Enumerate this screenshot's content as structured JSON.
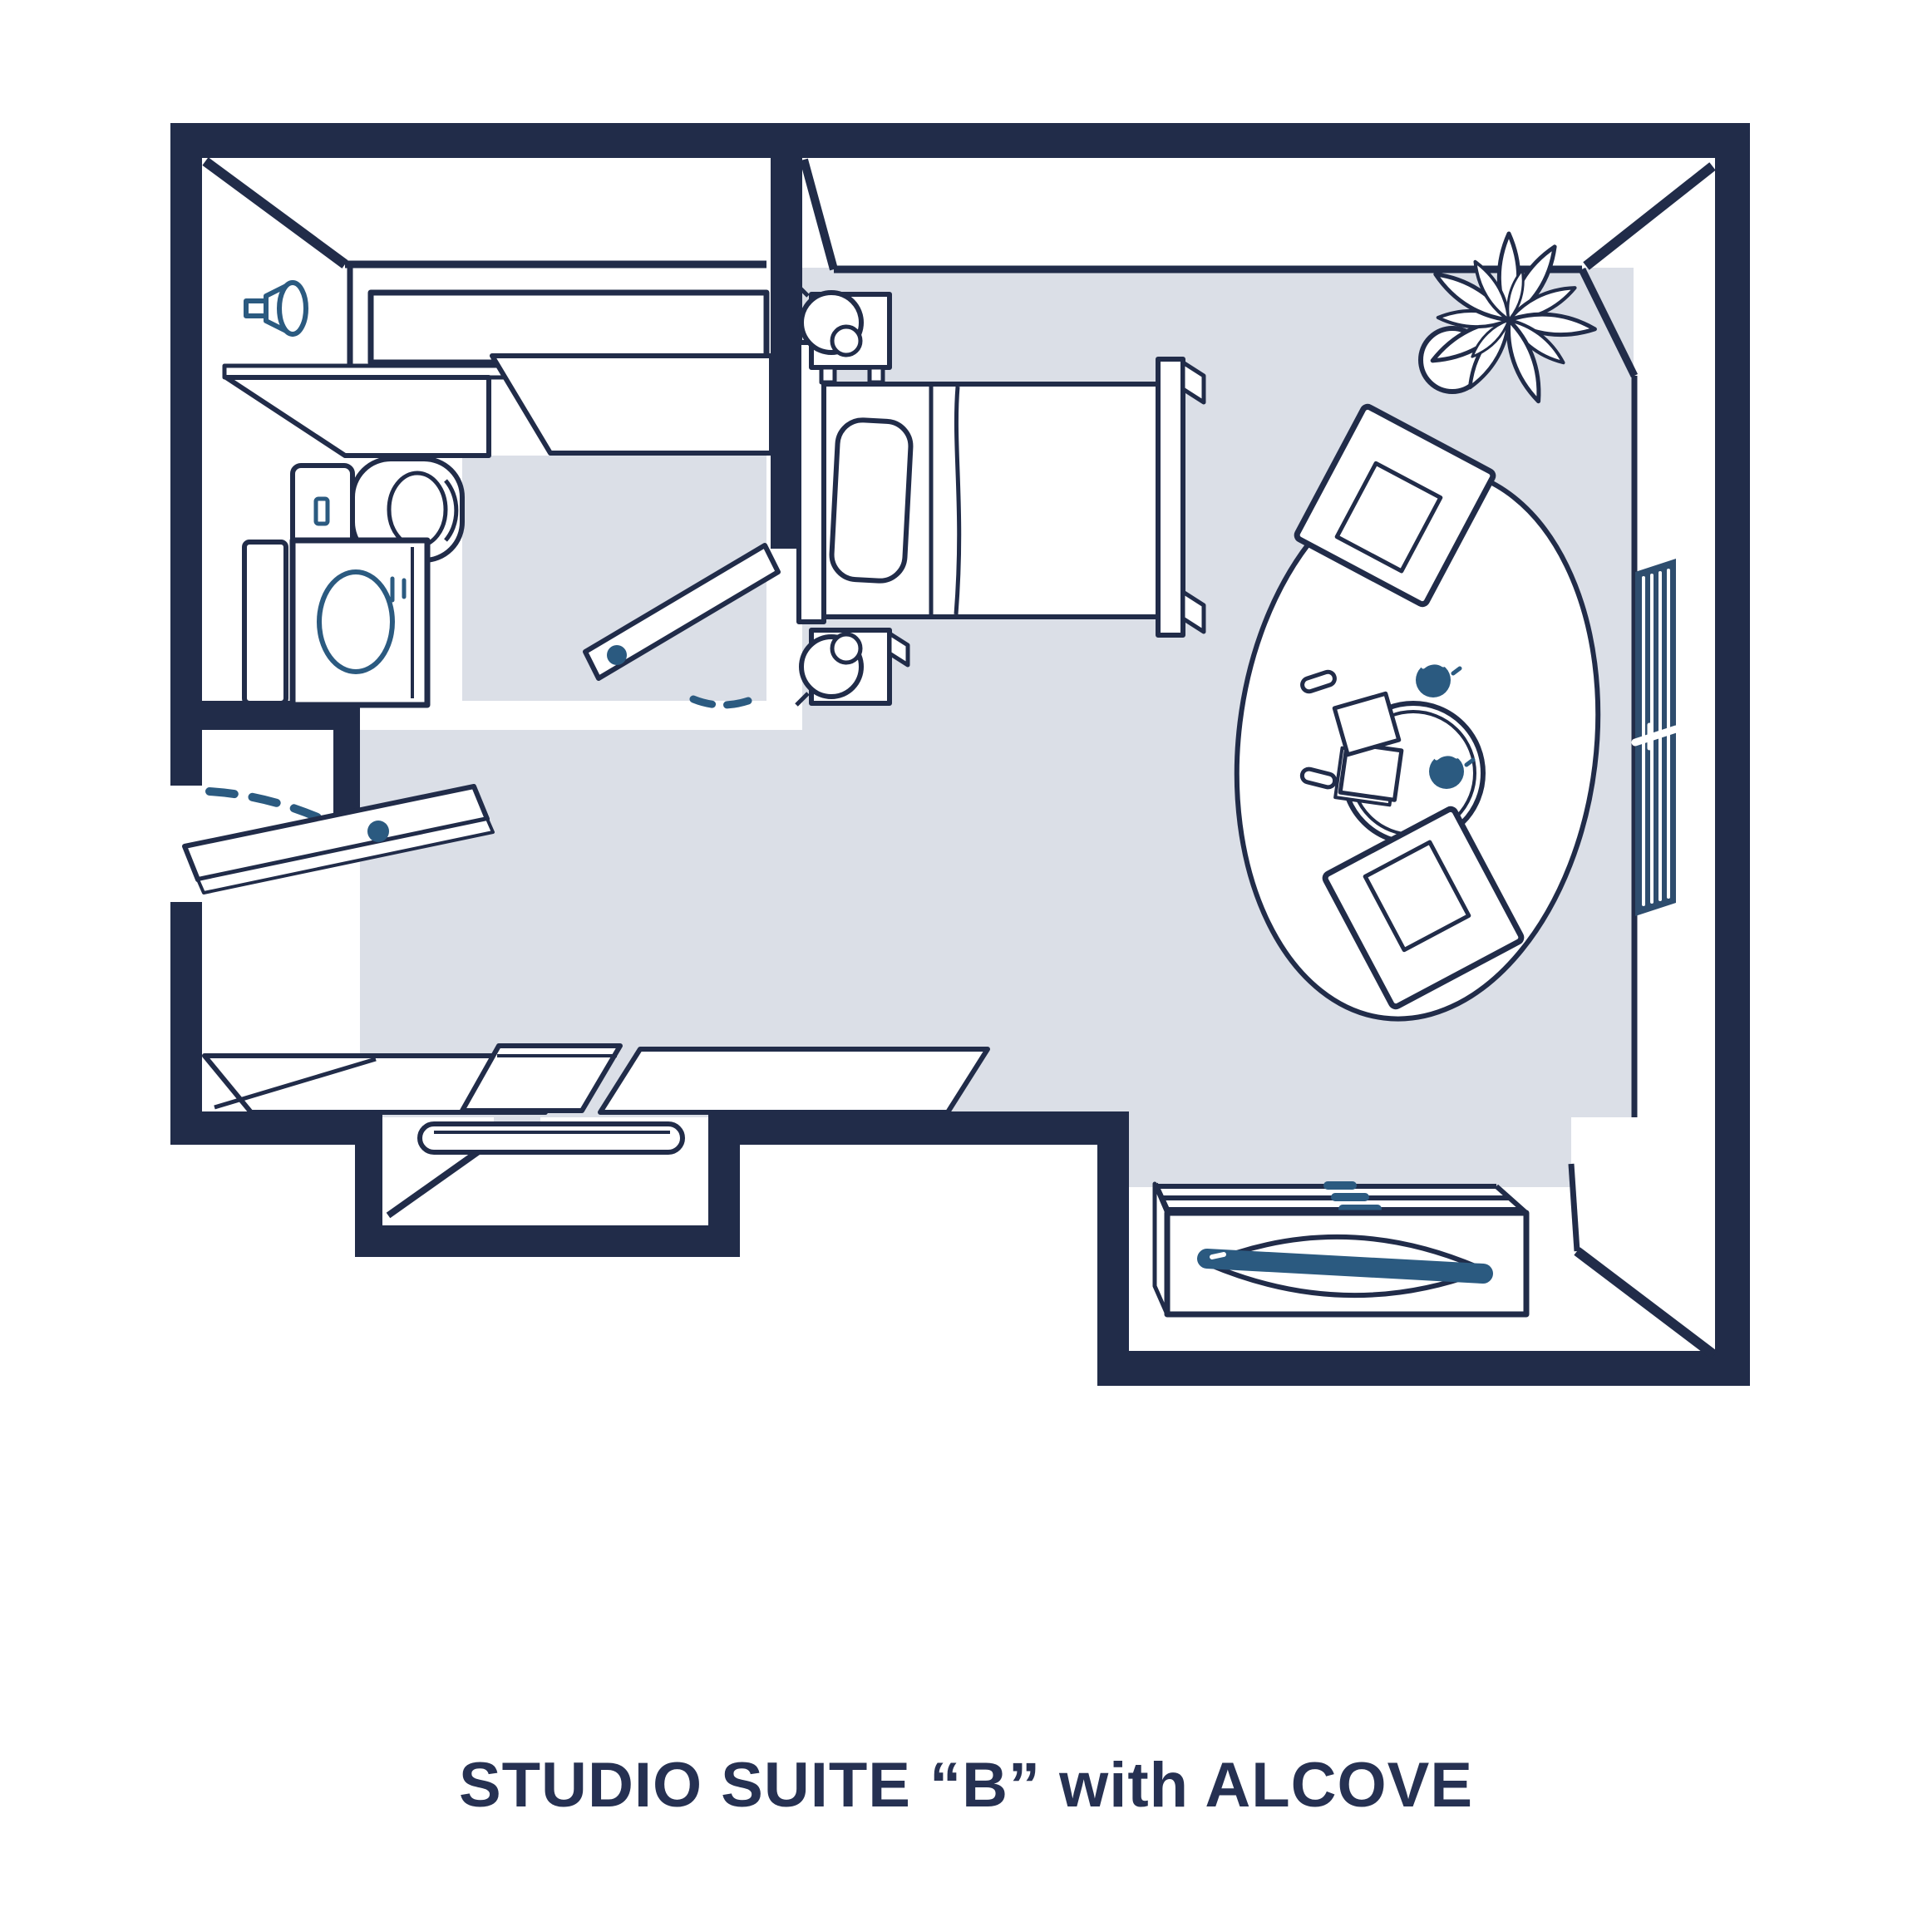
{
  "title": "STUDIO SUITE “B” with ALCOVE",
  "colors": {
    "wall_navy": "#212c49",
    "fixture_blue": "#2b5a80",
    "blinds_blue": "#2e4d6e",
    "floor_gray": "#dbdfe7",
    "background": "#ffffff",
    "caption_navy": "#263152"
  },
  "plan": {
    "type": "apartment-floor-plan",
    "rooms": [
      "bathroom",
      "studio-room",
      "entry",
      "alcove",
      "dresser-nook"
    ],
    "elements": [
      {
        "id": "wall-sconce-icon",
        "label": "wall light"
      },
      {
        "id": "vanity-mirror",
        "label": "mirror"
      },
      {
        "id": "vanity-counter",
        "label": "counter"
      },
      {
        "id": "toilet-icon",
        "label": "toilet"
      },
      {
        "id": "washer-icon",
        "label": "washer / dryer"
      },
      {
        "id": "bathroom-door",
        "label": "bathroom door (open)"
      },
      {
        "id": "entry-door",
        "label": "entry door (open)"
      },
      {
        "id": "closet-rod",
        "label": "closet rod"
      },
      {
        "id": "alcove-desk",
        "label": "alcove desk / counters"
      },
      {
        "id": "bed",
        "label": "bed with pillow"
      },
      {
        "id": "nightstand-upper",
        "label": "nightstand with lamp"
      },
      {
        "id": "nightstand-lower",
        "label": "nightstand with lamp"
      },
      {
        "id": "corner-plant-icon",
        "label": "plant"
      },
      {
        "id": "armchair-upper",
        "label": "armchair"
      },
      {
        "id": "armchair-lower",
        "label": "armchair"
      },
      {
        "id": "coffee-table",
        "label": "round table with cups and books"
      },
      {
        "id": "area-rug",
        "label": "oval rug"
      },
      {
        "id": "window-blinds-icon",
        "label": "window with blinds"
      },
      {
        "id": "dresser",
        "label": "dresser with handle"
      }
    ]
  }
}
